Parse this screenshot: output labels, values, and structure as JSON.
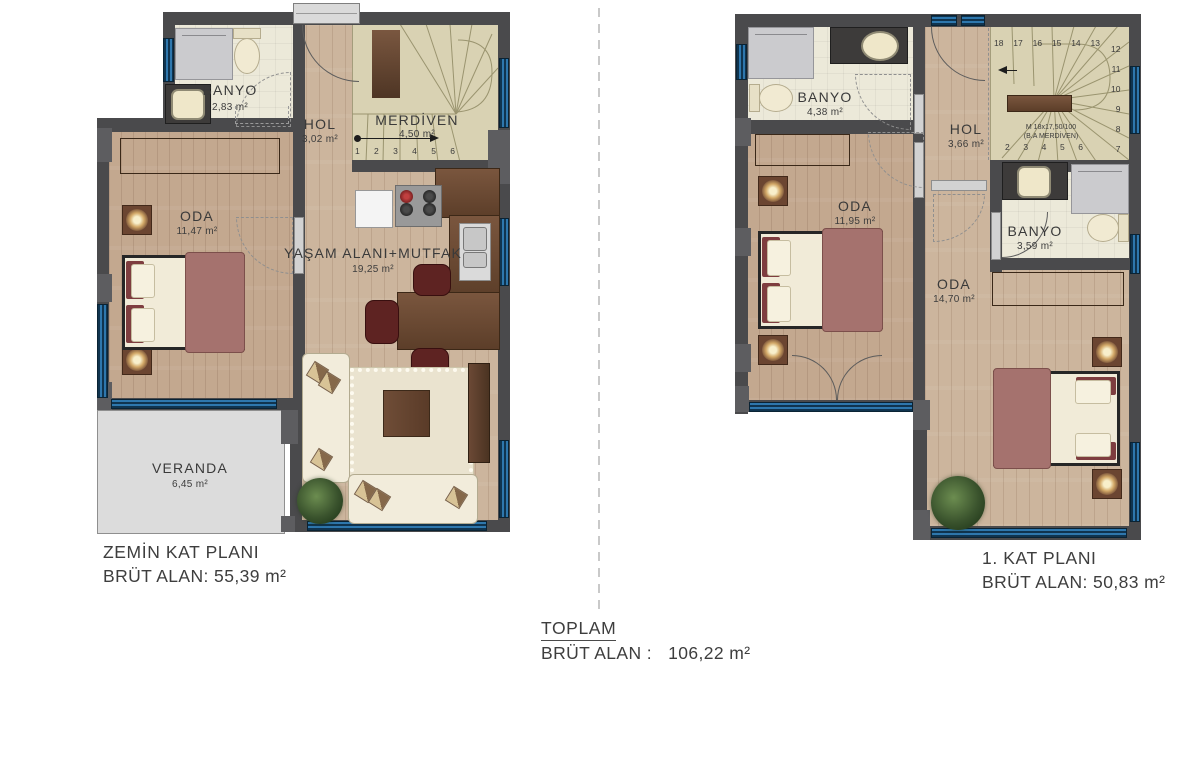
{
  "floor0": {
    "title": "ZEMİN KAT PLANI",
    "area_label": "BRÜT ALAN: 55,39 m²",
    "rooms": {
      "banyo": {
        "name": "BANYO",
        "area": "2,83 m²"
      },
      "hol": {
        "name": "HOL",
        "area": "3,02 m²"
      },
      "merdiven": {
        "name": "MERDİVEN",
        "area": "4,50 m²"
      },
      "oda": {
        "name": "ODA",
        "area": "11,47 m²"
      },
      "yasam": {
        "name": "YAŞAM ALANI+MUTFAK",
        "area": "19,25 m²"
      },
      "veranda": {
        "name": "VERANDA",
        "area": "6,45 m²"
      }
    },
    "stair_steps": [
      "1",
      "2",
      "3",
      "4",
      "5",
      "6"
    ]
  },
  "floor1": {
    "title": "1. KAT PLANI",
    "area_label": "BRÜT ALAN: 50,83 m²",
    "rooms": {
      "banyo_ust": {
        "name": "BANYO",
        "area": "4,38 m²"
      },
      "hol": {
        "name": "HOL",
        "area": "3,66 m²"
      },
      "oda_sol": {
        "name": "ODA",
        "area": "11,95 m²"
      },
      "banyo_orta": {
        "name": "BANYO",
        "area": "3,59 m²"
      },
      "oda_alt": {
        "name": "ODA",
        "area": "14,70 m²"
      }
    },
    "stairs": {
      "spec1": "M 18x17,50/100",
      "spec2": "(B.A MERDİVEN)",
      "top": [
        "18",
        "17",
        "16",
        "15",
        "14",
        "13"
      ],
      "right": [
        "12",
        "11",
        "10",
        "9",
        "8",
        "7"
      ],
      "bottom": [
        "2",
        "3",
        "4",
        "5",
        "6"
      ]
    }
  },
  "total": {
    "title": "TOPLAM",
    "label": "BRÜT ALAN :",
    "value": "106,22 m²"
  },
  "colors": {
    "wall": "#4a4a4c",
    "window_blue": "#2e77ad",
    "wood_floor": "#ccb59d",
    "bedroom_floor": "#c3a88f",
    "tile_floor": "#ece9d9",
    "stair_floor": "#d9d2b3",
    "veranda_floor": "#dcdcdc",
    "blanket_mauve": "#a5726e",
    "furniture_wood": "#6b4c36"
  }
}
